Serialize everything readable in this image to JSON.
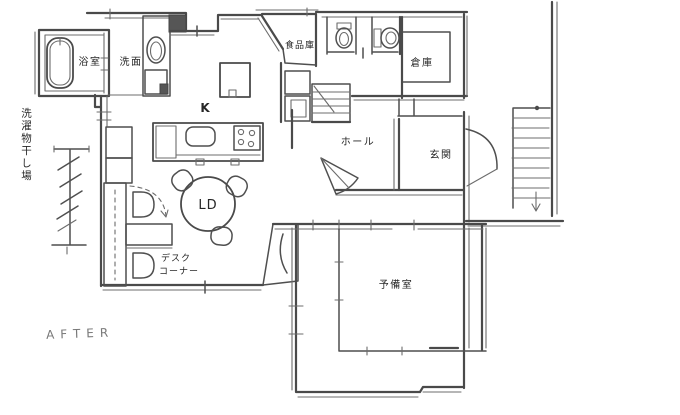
{
  "canvas": {
    "width": 680,
    "height": 415
  },
  "colors": {
    "ink": "#4a4a4a",
    "ink_light": "#6c6c6c",
    "paper": "#ffffff",
    "label_text": "#262626"
  },
  "rooms": {
    "bathroom": {
      "label": "浴室"
    },
    "washroom": {
      "label": "洗面"
    },
    "pantry": {
      "label": "食品庫"
    },
    "storage": {
      "label": "倉庫"
    },
    "kitchen": {
      "label": "K"
    },
    "hall": {
      "label": "ホール"
    },
    "entrance": {
      "label": "玄関"
    },
    "living_dining": {
      "label": "LD"
    },
    "spare_room": {
      "label": "予備室"
    },
    "desk_corner": {
      "label_line1": "デスク",
      "label_line2": "コーナー"
    },
    "laundry_area": {
      "label": "洗濯物干し場"
    }
  },
  "annotations": {
    "stage": "AFTER"
  },
  "fixtures": [
    "bathtub",
    "sink",
    "washing-machine",
    "refrigerator",
    "kitchen-counter",
    "stove",
    "toilet",
    "toilet",
    "dining-table",
    "chairs",
    "desk",
    "interior-staircase",
    "exterior-staircase",
    "drying-pole",
    "door-swings"
  ]
}
